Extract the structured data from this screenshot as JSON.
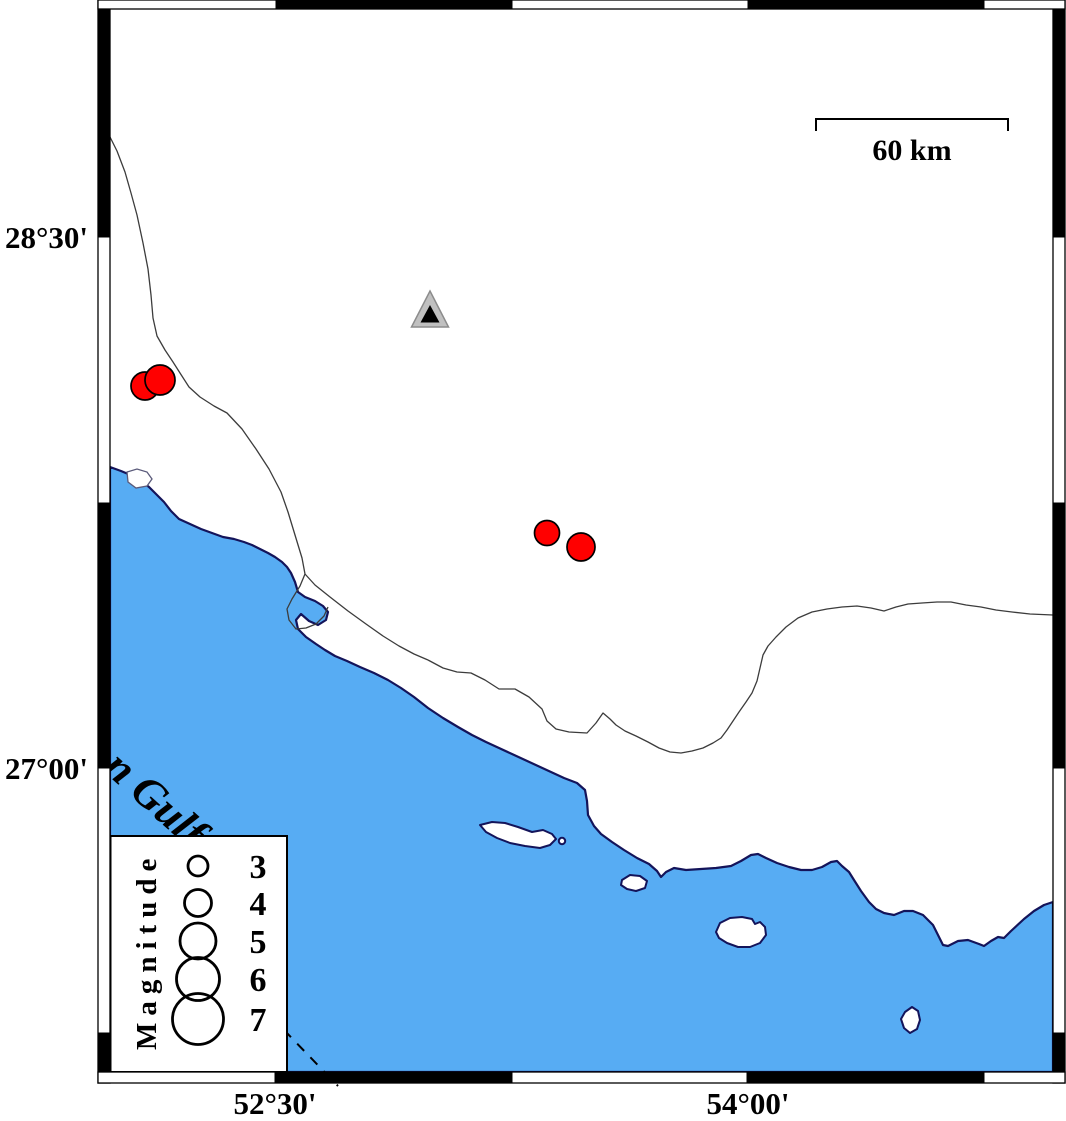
{
  "colors": {
    "sea": "#57ACF3",
    "coastline": "#14145A",
    "land": "#FFFFFF",
    "earthquake": "#FF0000",
    "marker_outline": "#000000",
    "station_outer": "#C0C0C0",
    "station_inner": "#000000",
    "frame": "#000000",
    "thin_line": "#3C3C3C"
  },
  "axis_labels": {
    "latitude": [
      {
        "label": "28°30'"
      },
      {
        "label": "27°00'"
      }
    ],
    "longitude": [
      {
        "label": "52°30'"
      },
      {
        "label": "54°00'"
      }
    ]
  },
  "scale_bar": {
    "label": "60 km"
  },
  "sea_label": {
    "text": "n Gulf"
  },
  "legend": {
    "title": "Magnitude",
    "entries": [
      {
        "label": "3",
        "radius": 10
      },
      {
        "label": "4",
        "radius": 13.5
      },
      {
        "label": "5",
        "radius": 18
      },
      {
        "label": "6",
        "radius": 21.5
      },
      {
        "label": "7",
        "radius": 25.5
      }
    ]
  },
  "markers": {
    "earthquakes": [
      {
        "cx": 145,
        "cy": 386,
        "r": 14
      },
      {
        "cx": 160,
        "cy": 380,
        "r": 15
      },
      {
        "cx": 547,
        "cy": 533,
        "r": 12.5
      },
      {
        "cx": 581,
        "cy": 547,
        "r": 14
      }
    ],
    "station": {
      "cx": 430,
      "cy": 313
    }
  }
}
